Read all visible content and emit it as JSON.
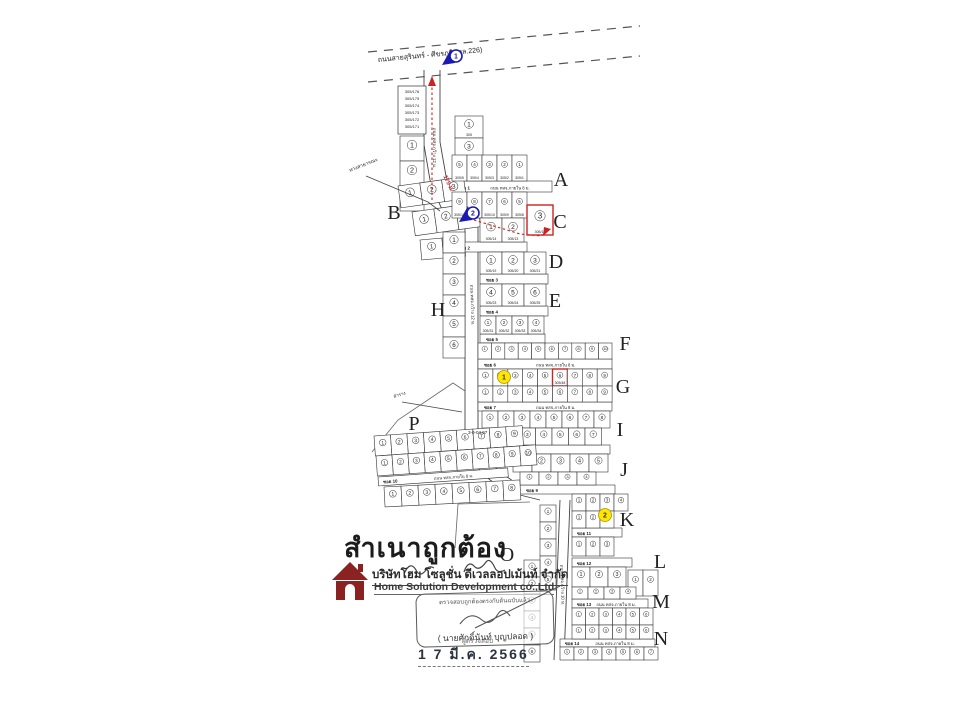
{
  "title_block": {
    "certified_text": "สำเนาถูกต้อง",
    "company_th": "บริษัทโฮม โซลูชั่น ดีเวลลอปเม้นท์ จำกัด",
    "company_en": "Home Solution Development co.,Ltd",
    "stamp_line": "ตรวจสอบถูกต้องตรงกับต้นฉบับแล้ว",
    "signer_name": "( นายศักดิ์นันท์ บุญปลอด )",
    "signer_role": "ผู้ตรวจสอบ",
    "date": "1 7 มี.ค. 2566"
  },
  "colors": {
    "ink": "#333333",
    "red": "#cc2222",
    "blue": "#1a1ab0",
    "yellow": "#ffe600",
    "logo": "#8b2222"
  },
  "map": {
    "highway": {
      "label": "ถนนสายสุรินทร์ - ศีขรภูมิ (ทล.226)",
      "lines": [
        [
          [
            368,
            52
          ],
          [
            640,
            26
          ]
        ],
        [
          [
            368,
            82
          ],
          [
            640,
            56
          ]
        ]
      ],
      "label_pos": [
        378,
        62
      ],
      "label_rot": -5.5
    },
    "entrance_length_label": {
      "t": "175 ม.",
      "x": 447,
      "y": 184,
      "rot": 64
    },
    "corridors": [
      [
        [
          424,
          70
        ],
        [
          424,
          145
        ],
        [
          430,
          180
        ],
        [
          440,
          205
        ],
        [
          447,
          220
        ]
      ],
      [
        [
          440,
          70
        ],
        [
          440,
          142
        ],
        [
          446,
          176
        ],
        [
          455,
          200
        ],
        [
          461,
          216
        ]
      ],
      [
        [
          465,
          222
        ],
        [
          465,
          440
        ],
        [
          472,
          462
        ],
        [
          490,
          480
        ],
        [
          512,
          493
        ],
        [
          540,
          500
        ]
      ],
      [
        [
          478,
          222
        ],
        [
          478,
          436
        ],
        [
          484,
          456
        ],
        [
          500,
          472
        ],
        [
          520,
          486
        ],
        [
          543,
          493
        ]
      ],
      [
        [
          560,
          500
        ],
        [
          554,
          660
        ]
      ],
      [
        [
          570,
          500
        ],
        [
          564,
          660
        ]
      ]
    ],
    "outlines": [
      [
        [
          372,
          452
        ],
        [
          398,
          420
        ],
        [
          453,
          383
        ],
        [
          465,
          391
        ]
      ],
      [
        [
          458,
          504
        ],
        [
          530,
          502
        ]
      ],
      [
        [
          458,
          504
        ],
        [
          455,
          548
        ]
      ]
    ],
    "vroads": [
      {
        "t": "ถนน ทสจ.กว้าง 12 ม.",
        "x": 433,
        "y": 148,
        "rot": 90
      },
      {
        "t": "ถนน ทสจ.กว้าง 12 ม.",
        "x": 471,
        "y": 305,
        "rot": 88
      },
      {
        "t": "ถนน ทสจ.กว้าง 10 ม.",
        "x": 561,
        "y": 585,
        "rot": 88
      }
    ],
    "strips": [
      {
        "x": 452,
        "y": 181,
        "w": 100,
        "h": 11,
        "soi": "ซอย 1",
        "road": "ถนน ทสจ.ภายใน 8 ม."
      },
      {
        "x": 452,
        "y": 242,
        "w": 75,
        "h": 10,
        "soi": "ซอย 2",
        "road": ""
      },
      {
        "x": 480,
        "y": 274,
        "w": 68,
        "h": 10,
        "soi": "ซอย 3",
        "road": ""
      },
      {
        "x": 480,
        "y": 306,
        "w": 68,
        "h": 10,
        "soi": "ซอย 4",
        "road": ""
      },
      {
        "x": 480,
        "y": 334,
        "w": 65,
        "h": 9,
        "soi": "ซอย 5",
        "road": ""
      },
      {
        "x": 478,
        "y": 359,
        "w": 134,
        "h": 10,
        "soi": "ซอย 6",
        "road": "ถนน ทสจ.ภายใน 8 ม."
      },
      {
        "x": 478,
        "y": 402,
        "w": 134,
        "h": 9,
        "soi": "ซอย 7",
        "road": "ถนน ทสจ.ภายใน 8 ม."
      },
      {
        "x": 490,
        "y": 445,
        "w": 120,
        "h": 9,
        "soi": "ซอย 8",
        "road": ""
      },
      {
        "x": 520,
        "y": 485,
        "w": 95,
        "h": 9,
        "soi": "ซอย 9",
        "road": ""
      },
      {
        "x": 378,
        "y": 477,
        "w": 130,
        "h": 9,
        "rot": -4,
        "soi": "ซอย 10",
        "road": "ถนน ทสจ.ภายใน 8 ม."
      },
      {
        "x": 572,
        "y": 528,
        "w": 50,
        "h": 9,
        "soi": "ซอย 11",
        "road": ""
      },
      {
        "x": 572,
        "y": 558,
        "w": 60,
        "h": 9,
        "soi": "ซอย 12",
        "road": ""
      },
      {
        "x": 572,
        "y": 599,
        "w": 76,
        "h": 9,
        "soi": "ซอย 13",
        "road": "ถนน ทสจ.ภายใน 8 ม."
      },
      {
        "x": 560,
        "y": 639,
        "w": 95,
        "h": 8,
        "soi": "ซอย 14",
        "road": "ถนน ทสจ.ภายใน 8 ม."
      }
    ],
    "blocks": [
      {
        "name": "stack-plot",
        "x": 398,
        "y": 86,
        "cols": 1,
        "cw": 28,
        "ch": 48,
        "multi": [
          "305/176",
          "305/175",
          "305/174",
          "305/173",
          "305/172",
          "305/171"
        ]
      },
      {
        "x": 400,
        "y": 136,
        "dir": "v",
        "cols": 3,
        "cw": 24,
        "ch": 25
      },
      {
        "x": 455,
        "y": 116,
        "dir": "v",
        "cols": 2,
        "cw": 28,
        "ch": 22,
        "labels": [
          "305",
          "305/1"
        ],
        "nums": [
          1,
          3
        ]
      },
      {
        "x": 398,
        "y": 186,
        "cols": 3,
        "cw": 22,
        "ch": 22,
        "rot": -8
      },
      {
        "x": 412,
        "y": 212,
        "cols": 3,
        "cw": 22,
        "ch": 24,
        "rot": -8
      },
      {
        "x": 420,
        "y": 240,
        "cols": 2,
        "cw": 22,
        "ch": 20,
        "rot": -5
      },
      {
        "x": 452,
        "y": 155,
        "cols": 5,
        "cw": 15,
        "ch": 26,
        "labels": [
          "305/5",
          "305/4",
          "305/3",
          "305/2",
          "305/1"
        ],
        "nums": [
          5,
          4,
          3,
          2,
          1
        ]
      },
      {
        "x": 452,
        "y": 192,
        "cols": 5,
        "cw": 15,
        "ch": 26,
        "labels": [
          "305/12",
          "305/11",
          "305/10",
          "305/9",
          "305/8"
        ],
        "nums": [
          9,
          8,
          7,
          6,
          5
        ]
      },
      {
        "x": 480,
        "y": 218,
        "cols": 2,
        "cw": 22,
        "ch": 24,
        "labels": [
          "305/14",
          "305/13"
        ]
      },
      {
        "x": 527,
        "y": 205,
        "cols": 1,
        "cw": 26,
        "ch": 30,
        "labels": [
          "305/18"
        ],
        "nums": [
          3
        ],
        "red": [
          0
        ]
      },
      {
        "x": 480,
        "y": 252,
        "cols": 3,
        "cw": 22,
        "ch": 22,
        "labels": [
          "305/19",
          "305/20",
          "305/21"
        ]
      },
      {
        "x": 480,
        "y": 284,
        "cols": 3,
        "cw": 22,
        "ch": 22,
        "labels": [
          "305/23",
          "305/24",
          "305/25"
        ],
        "nums": [
          4,
          5,
          6
        ]
      },
      {
        "x": 480,
        "y": 316,
        "cols": 4,
        "cw": 16,
        "ch": 18,
        "labels": [
          "305/31",
          "305/32",
          "305/33",
          "305/34"
        ]
      },
      {
        "x": 443,
        "y": 232,
        "dir": "v",
        "cols": 6,
        "cw": 22,
        "ch": 21
      },
      {
        "x": 478,
        "y": 343,
        "cols": 10,
        "cw": 13.4,
        "ch": 16
      },
      {
        "x": 478,
        "y": 369,
        "cols": 9,
        "cw": 14.9,
        "ch": 17,
        "red": [
          5
        ],
        "labels": [
          "",
          "",
          "",
          "",
          "",
          "305/48",
          "",
          "",
          ""
        ]
      },
      {
        "x": 478,
        "y": 386,
        "cols": 9,
        "cw": 14.9,
        "ch": 16
      },
      {
        "x": 482,
        "y": 411,
        "cols": 8,
        "cw": 16,
        "ch": 17
      },
      {
        "x": 486,
        "y": 428,
        "cols": 7,
        "cw": 16.5,
        "ch": 17
      },
      {
        "x": 513,
        "y": 454,
        "cols": 5,
        "cw": 19,
        "ch": 18
      },
      {
        "x": 520,
        "y": 472,
        "cols": 4,
        "cw": 19,
        "ch": 13
      },
      {
        "x": 572,
        "y": 494,
        "cols": 4,
        "cw": 14,
        "ch": 17
      },
      {
        "x": 572,
        "y": 511,
        "cols": 3,
        "cw": 14,
        "ch": 17
      },
      {
        "x": 572,
        "y": 537,
        "cols": 3,
        "cw": 14,
        "ch": 19
      },
      {
        "x": 374,
        "y": 436,
        "cols": 9,
        "cw": 16.5,
        "ch": 20,
        "rot": -4
      },
      {
        "x": 376,
        "y": 456,
        "cols": 10,
        "cw": 16,
        "ch": 20,
        "rot": -4
      },
      {
        "x": 384,
        "y": 487,
        "cols": 8,
        "cw": 17,
        "ch": 20,
        "rot": -3
      },
      {
        "x": 540,
        "y": 505,
        "dir": "v",
        "cols": 5,
        "cw": 16,
        "ch": 17
      },
      {
        "x": 524,
        "y": 560,
        "dir": "v",
        "cols": 6,
        "cw": 16,
        "ch": 17
      },
      {
        "x": 572,
        "y": 567,
        "cols": 3,
        "cw": 18,
        "ch": 20
      },
      {
        "x": 628,
        "y": 570,
        "cols": 2,
        "cw": 15,
        "ch": 26
      },
      {
        "x": 572,
        "y": 587,
        "cols": 4,
        "cw": 16,
        "ch": 12
      },
      {
        "x": 572,
        "y": 608,
        "cols": 6,
        "cw": 13.5,
        "ch": 17
      },
      {
        "x": 572,
        "y": 625,
        "cols": 6,
        "cw": 13.5,
        "ch": 14
      },
      {
        "x": 560,
        "y": 647,
        "cols": 7,
        "cw": 14,
        "ch": 13
      }
    ],
    "letters": [
      {
        "t": "A",
        "x": 561,
        "y": 186
      },
      {
        "t": "B",
        "x": 394,
        "y": 219
      },
      {
        "t": "C",
        "x": 560,
        "y": 228
      },
      {
        "t": "D",
        "x": 556,
        "y": 268
      },
      {
        "t": "E",
        "x": 555,
        "y": 307
      },
      {
        "t": "F",
        "x": 625,
        "y": 350
      },
      {
        "t": "G",
        "x": 623,
        "y": 393
      },
      {
        "t": "H",
        "x": 438,
        "y": 316
      },
      {
        "t": "I",
        "x": 620,
        "y": 436
      },
      {
        "t": "J",
        "x": 624,
        "y": 476
      },
      {
        "t": "K",
        "x": 627,
        "y": 526
      },
      {
        "t": "L",
        "x": 660,
        "y": 568
      },
      {
        "t": "M",
        "x": 661,
        "y": 608
      },
      {
        "t": "N",
        "x": 661,
        "y": 645
      },
      {
        "t": "O",
        "x": 507,
        "y": 561
      },
      {
        "t": "P",
        "x": 414,
        "y": 430
      }
    ],
    "area_labels": [
      {
        "t": "3-0-04.97",
        "x": 468,
        "y": 434,
        "fs": 4.5
      },
      {
        "t": "ทางสาธารณะ",
        "x": 350,
        "y": 172,
        "rot": -22,
        "fs": 5,
        "leader": [
          [
            366,
            176
          ],
          [
            428,
            202
          ],
          [
            440,
            211
          ]
        ]
      },
      {
        "t": "ลำราง",
        "x": 394,
        "y": 398,
        "rot": -18,
        "fs": 4.5,
        "leader": [
          [
            402,
            402
          ],
          [
            462,
            412
          ]
        ]
      }
    ],
    "red_routes": [
      {
        "pts": [
          [
            432,
            200
          ],
          [
            432,
            82
          ]
        ],
        "arrow": [
          [
            428,
            86
          ],
          [
            432,
            76
          ],
          [
            436,
            86
          ]
        ]
      },
      {
        "pts": [
          [
            474,
            220
          ],
          [
            520,
            234
          ],
          [
            541,
            236
          ],
          [
            548,
            231
          ]
        ],
        "arrow": [
          [
            543,
            236
          ],
          [
            551,
            229
          ],
          [
            544,
            227
          ]
        ]
      }
    ],
    "markers": {
      "blue": [
        {
          "n": "1",
          "x": 453,
          "y": 56
        },
        {
          "n": "2",
          "x": 470,
          "y": 213
        }
      ],
      "yellow": [
        {
          "n": "1",
          "x": 504,
          "y": 377
        },
        {
          "n": "2",
          "x": 605,
          "y": 515
        }
      ]
    }
  }
}
